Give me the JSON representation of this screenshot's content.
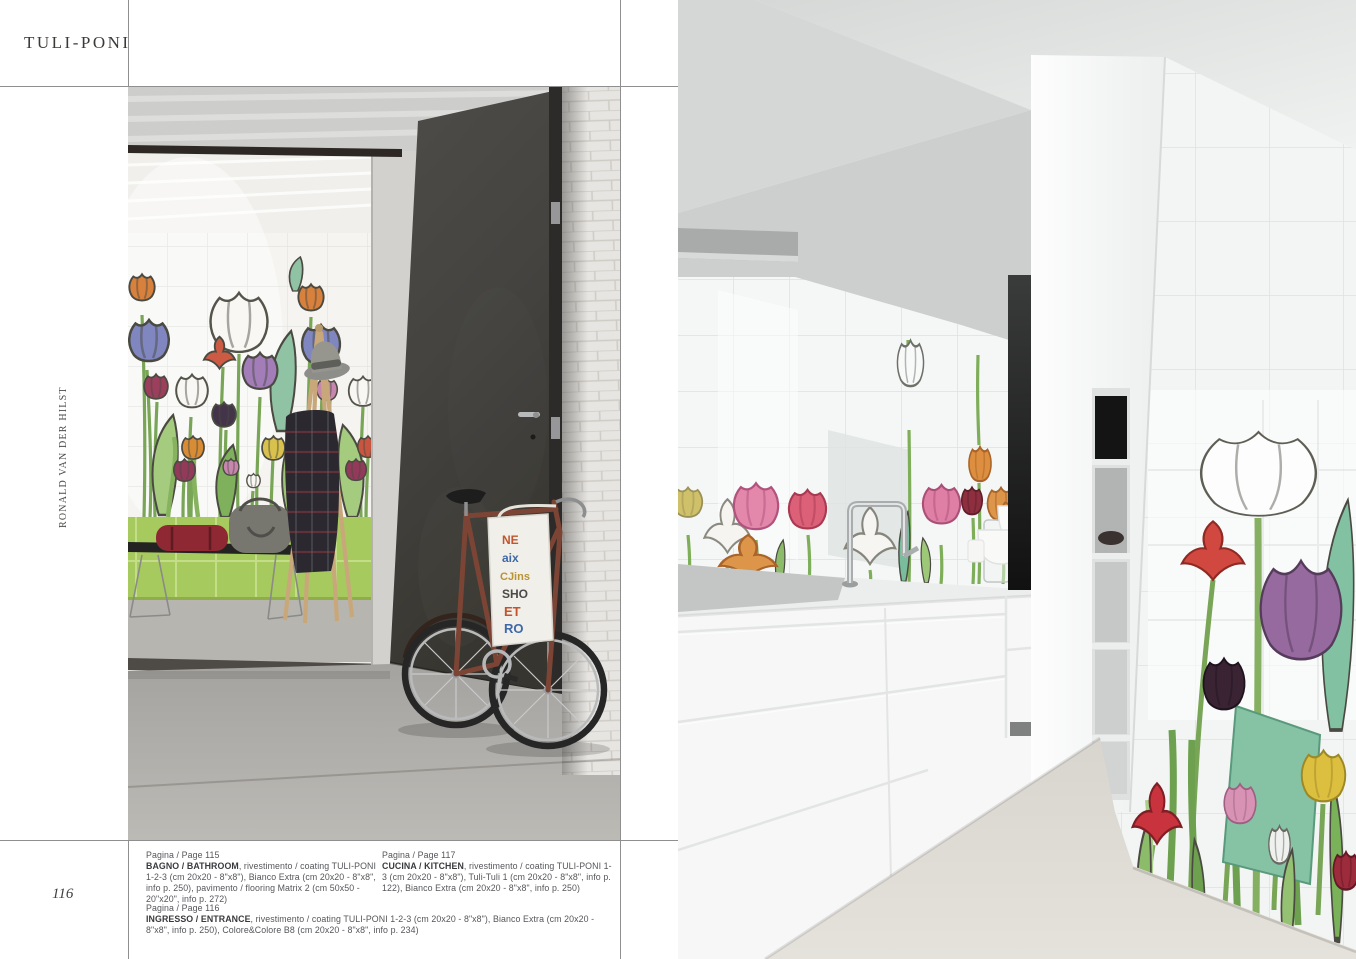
{
  "page": {
    "title": "TULI-PONI",
    "designer": "RONALD VAN DER HILST",
    "page_number": "116"
  },
  "captions": {
    "bathroom": {
      "page_ref": "Pagina / Page 115",
      "label": "BAGNO / BATHROOM",
      "details": ", rivestimento / coating TULI-PONI 1-2-3 (cm 20x20 - 8\"x8\"), Bianco Extra (cm 20x20 - 8\"x8\", info p. 250), pavimento / flooring Matrix 2 (cm 50x50 - 20\"x20\", info p. 272)"
    },
    "kitchen": {
      "page_ref": "Pagina / Page 117",
      "label": "CUCINA / KITCHEN",
      "details": ", rivestimento / coating TULI-PONI 1-3 (cm 20x20 - 8\"x8\"), Tuli-Tuli 1 (cm 20x20 - 8\"x8\", info p. 122), Bianco Extra (cm 20x20 - 8\"x8\", info p. 250)"
    },
    "entrance": {
      "page_ref": "Pagina / Page 116",
      "label": "INGRESSO / ENTRANCE",
      "details": ", rivestimento / coating TULI-PONI 1-2-3 (cm 20x20 - 8\"x8\"), Bianco Extra (cm 20x20 - 8\"x8\", info p. 250), Colore&Colore B8 (cm 20x20 - 8\"x8\", info p. 234)"
    }
  },
  "photos": {
    "left": {
      "tote_bag_lines": [
        "NE",
        "aix",
        "CJins",
        "SHO",
        "ET",
        "RO"
      ]
    }
  },
  "palette": {
    "rule_gray": "#8f8f8f",
    "lime_tile_green": "#a7ca5e",
    "door_charcoal": "#44423f",
    "stem_green": "#79a557",
    "teal_leaf": "#82c1a2",
    "tulip_orange": "#d8813c",
    "tulip_violet": "#8087c0",
    "tulip_purple": "#96699f",
    "tulip_pink": "#e387ab",
    "tulip_red": "#cd4a3e",
    "tulip_maroon": "#9c3f5c",
    "tulip_plum": "#3a2433",
    "tulip_yellow": "#d9c14e"
  }
}
